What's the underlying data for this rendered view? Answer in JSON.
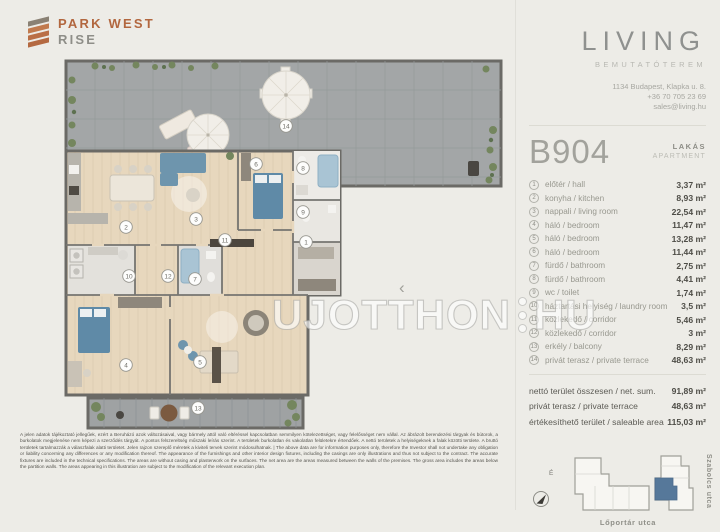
{
  "brand": {
    "line1": "PARK WEST",
    "line2": "RISE"
  },
  "showroom": {
    "name": "LIVING",
    "subtitle": "BEMUTATÓTEREM",
    "address": "1134 Budapest, Klapka u. 8.",
    "phone": "+36 70 705 23 69",
    "email": "sales@living.hu"
  },
  "unit": {
    "code": "B904",
    "type_hu": "LAKÁS",
    "type_en": "APARTMENT"
  },
  "separator": "/",
  "rooms": [
    {
      "num": "1",
      "hu": "előtér",
      "en": "hall",
      "area": "3,37 m²"
    },
    {
      "num": "2",
      "hu": "konyha",
      "en": "kitchen",
      "area": "8,93 m²"
    },
    {
      "num": "3",
      "hu": "nappali",
      "en": "living room",
      "area": "22,54 m²"
    },
    {
      "num": "4",
      "hu": "háló",
      "en": "bedroom",
      "area": "11,47 m²"
    },
    {
      "num": "5",
      "hu": "háló",
      "en": "bedroom",
      "area": "13,28 m²"
    },
    {
      "num": "6",
      "hu": "háló",
      "en": "bedroom",
      "area": "11,44 m²"
    },
    {
      "num": "7",
      "hu": "fürdő",
      "en": "bathroom",
      "area": "2,75 m²"
    },
    {
      "num": "8",
      "hu": "fürdő",
      "en": "bathroom",
      "area": "4,41 m²"
    },
    {
      "num": "9",
      "hu": "wc",
      "en": "toilet",
      "area": "1,74 m²"
    },
    {
      "num": "10",
      "hu": "háztartási helyiség",
      "en": "laundry room",
      "area": "3,5 m²"
    },
    {
      "num": "11",
      "hu": "közlekedő",
      "en": "corridor",
      "area": "5,46 m²"
    },
    {
      "num": "12",
      "hu": "közlekedő",
      "en": "corridor",
      "area": "3 m²"
    },
    {
      "num": "13",
      "hu": "erkély",
      "en": "balcony",
      "area": "8,29 m²"
    },
    {
      "num": "14",
      "hu": "privát terasz",
      "en": "private terrace",
      "area": "48,63 m²"
    }
  ],
  "summary": [
    {
      "label": "nettó terület összesen / net. sum.",
      "value": "91,89 m²"
    },
    {
      "label": "privát terasz  /  private terrace",
      "value": "48,63 m²"
    },
    {
      "label": "értékesíthető terület / saleable area",
      "value": "115,03 m²"
    }
  ],
  "floor_plan": {
    "watermark_left": "UJOTTHON",
    "watermark_right": "HU",
    "nav_prev": "‹"
  },
  "site_plan": {
    "street_bottom": "Lőportár utca",
    "street_right": "Szabolcs utca",
    "compass": "É",
    "highlight_color": "#56789a"
  },
  "disclaimer": "A jelen adatok tájékoztató jellegűek, ezért a Beruházó azok változásaival, vagy bármely attól való eltéréssel kapcsolatban semmilyen kötelezettséget, vagy felelősséget nem vállal. Az ábrázolt berendezési tárgyak és bútorok, a burkolatok megjelenése nem képezi a szerződés tárgyát. A pontos felszereltség műszaki leírás szerint. A területek burkolatlan és vakolatlan felületekre értendőek. A nettó területek a helyiségeknek a falak közötti területe. A bruttó területek tartalmazzák a válaszfalak alatti területet. Jelen rajzon szereplő méretek a kiviteli tervek szerint módosulhatnak. | The above data are for information purposes only, therefore the Investor shall not undertake any obligation or liability concerning any differences or any modification thereof. The appearance of the furnishings and other interior design fixtures, including the casings are only illustrations and thus not subject to the contract. The accurate fixtures are included in the technical specifications. The areas are without casing and plasterwork on the surfaces. The net area are the areas measured between the walls of the premises. The gross area includes the areas below the partition walls. The areas appearing in this illustration are subject to the modification of the relevant execution plan."
}
